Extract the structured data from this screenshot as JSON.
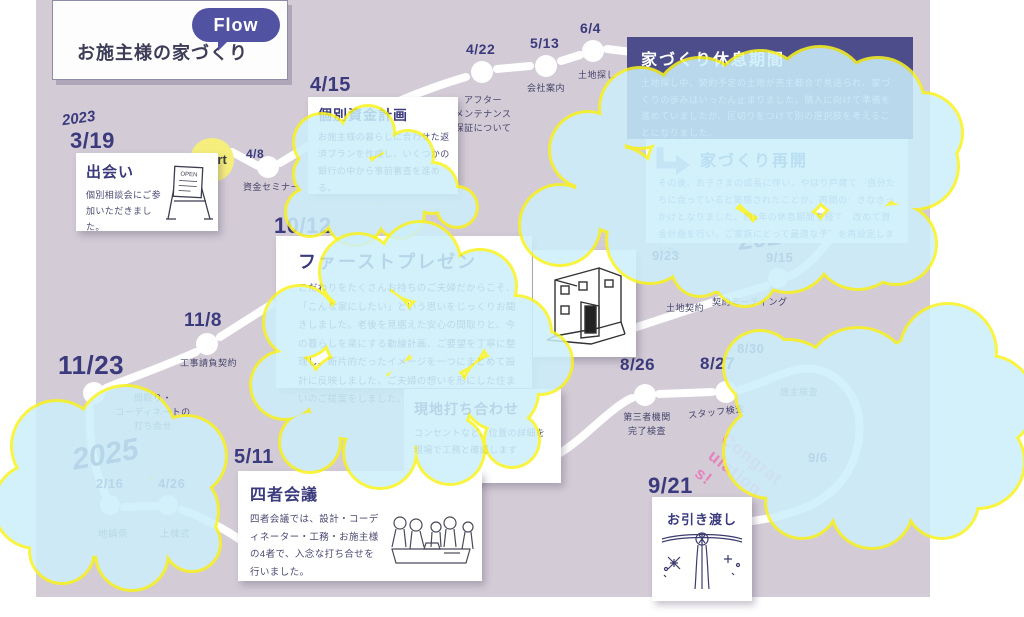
{
  "title_card": {
    "title": "お施主様の家づくり",
    "badge": "Flow"
  },
  "start_label": "Start",
  "congrats": "Congratulations!",
  "years": {
    "y2023": "2023",
    "y2024": "2024",
    "y2025": "2025"
  },
  "cards": {
    "deai": {
      "date": "3/19",
      "title": "出会い",
      "body": "個別相談会にご参加いただきました。"
    },
    "shikin": {
      "date": "4/15",
      "title": "個別資金計画",
      "body": "お施主様の暮らしに合わせた返済プランを作成し、いくつかの銀行の中から事前審査を進める。"
    },
    "presen": {
      "date": "10/12",
      "title": "ファーストプレゼン",
      "body": "こだわりをたくさんお持ちのご夫婦だからこそ、「こんな家にしたい」という思いをじっくりお聞きしました。老後を見据えた安心の間取りと、今の暮らしを楽にする動線計画、ご要望を丁寧に整理し、断片的だったイメージを一つにまとめて設計に反映しました。ご夫婦の想いを形にした住まいのご提案をしました。",
      "house_icon": "house-illustration"
    },
    "rest": {
      "title": "家づくり休息期間",
      "body": "土地探し中、契約予定の土地が売主都合で見送られ、家づくりの歩みはいったん止まりました。購入に向けて準備を進めていましたが、区切りをつけて別の選択肢を考えることになりました。"
    },
    "resume": {
      "title": "家づくり再開",
      "body": "その後、お子さまの成長に伴い、やはり戸建てが自分たちに合っていると実感されたことが、再開の大きなきっかけとなりました。約1年の休息期間を経て、改めて資金計画を行い、ご家族にとって最適な予算を再設定しました。"
    },
    "genchi": {
      "date": "6/7",
      "title": "現地打ち合わせ",
      "body": "コンセントなど、位置の詳細を現場で工務と確認します"
    },
    "yonsha": {
      "date": "5/11",
      "title": "四者会議",
      "body": "四者会議では、設計・コーディネーター・工務・お施主様の4者で、入念な打ち合せを行いました。"
    },
    "hikiwatashi": {
      "date": "9/21",
      "title": "お引き渡し"
    }
  },
  "milestones": [
    {
      "date": "4/8",
      "label": "資金セミナー"
    },
    {
      "date": "4/22",
      "label": "アフター\nメンテナンス\n保証について"
    },
    {
      "date": "5/13",
      "label": "会社案内"
    },
    {
      "date": "6/4",
      "label": "土地探し"
    },
    {
      "date": "9/15",
      "label": "契約ミーティング"
    },
    {
      "date": "9/23",
      "label": "土地契約"
    },
    {
      "date": "11/8",
      "label": "工事請負契約"
    },
    {
      "date": "11/23",
      "label": "間取り・\nコーディネートの\n打ち合せ"
    },
    {
      "date": "2/16",
      "label": "地鎮祭"
    },
    {
      "date": "4/26",
      "label": "上棟式"
    },
    {
      "date": "8/26",
      "label": "第三者機関\n完了検査"
    },
    {
      "date": "8/27",
      "label": "スタッフ検査"
    },
    {
      "date": "8/30",
      "label": "施主検査"
    },
    {
      "date": "9/6",
      "label": ""
    }
  ],
  "colors": {
    "canvas": "#d3cbd6",
    "navy": "#3a3a7c",
    "purple_box": "#4d4d8c",
    "badge": "#5152a2",
    "cloud_fill": "#cceffb",
    "cloud_border": "#f8f320",
    "start_yellow": "#f5ee7d",
    "congrats_pink": "#e583bd",
    "path": "#ffffff"
  }
}
